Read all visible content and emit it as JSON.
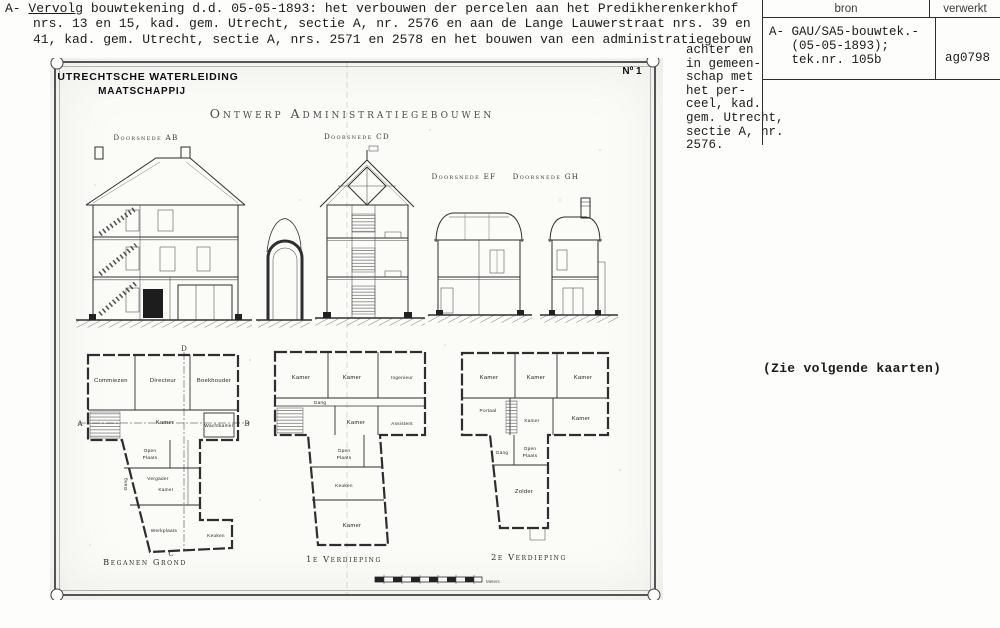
{
  "card": {
    "typed_note": {
      "prefix": "A-",
      "underlined_word": "Vervolg",
      "line1_rest": " bouwtekening d.d. 05-05-1893: het verbouwen der percelen aan het Predikherenkerkhof",
      "wrapped_lines": "nrs. 13 en 15, kad. gem. Utrecht, sectie A, nr. 2576 en aan de Lange Lauwerstraat nrs. 39 en\n41, kad. gem. Utrecht, sectie A, nrs. 2571 en 2578 en het bouwen van een administratiegebouw",
      "continuation": "achter en\nin gemeen-\nschap met\nhet per-\nceel, kad.\ngem. Utrecht,\nsectie A, nr.\n2576."
    },
    "source_table": {
      "col_bron": "bron",
      "col_verwerkt": "verwerkt",
      "bron_entry": "A- GAU/SA5-bouwtek.-\n   (05-05-1893);\n   tek.nr. 105b",
      "verwerkt_entry": "ag0798"
    },
    "see_note": "(Zie volgende kaarten)"
  },
  "drawing": {
    "company": {
      "line1": "UTRECHTSCHE WATERLEIDING",
      "line2": "MAATSCHAPPIJ"
    },
    "sheet_no": "Nº 1",
    "title": "Ontwerp Administratiegebouwen",
    "sections": [
      "Doorsnede AB",
      "Doorsnede CD",
      "Doorsnede EF",
      "Doorsnede GH"
    ],
    "plans": [
      {
        "label": "Beganen Grond",
        "rooms": [
          "Commiezen",
          "Directeur",
          "Boekhouder",
          "Kamer",
          "Wachtkamer",
          "Open",
          "Plaats",
          "Vergader",
          "Kamer",
          "Werkplaats",
          "Keuken",
          "Gang"
        ]
      },
      {
        "label": "1e Verdieping",
        "rooms": [
          "Kamer",
          "Kamer",
          "Ingenieur",
          "Gang",
          "Kamer",
          "Assistent",
          "Open",
          "Plaats",
          "Keuken",
          "Kamer"
        ]
      },
      {
        "label": "2e Verdieping",
        "rooms": [
          "Kamer",
          "Kamer",
          "Kamer",
          "Portaal",
          "Kamer",
          "Kamer",
          "Gang",
          "Open",
          "Plaats",
          "Zolder"
        ]
      }
    ],
    "markers": {
      "a": "A",
      "b": "B",
      "c": "C",
      "d": "D"
    },
    "scale_label": "Meters"
  }
}
